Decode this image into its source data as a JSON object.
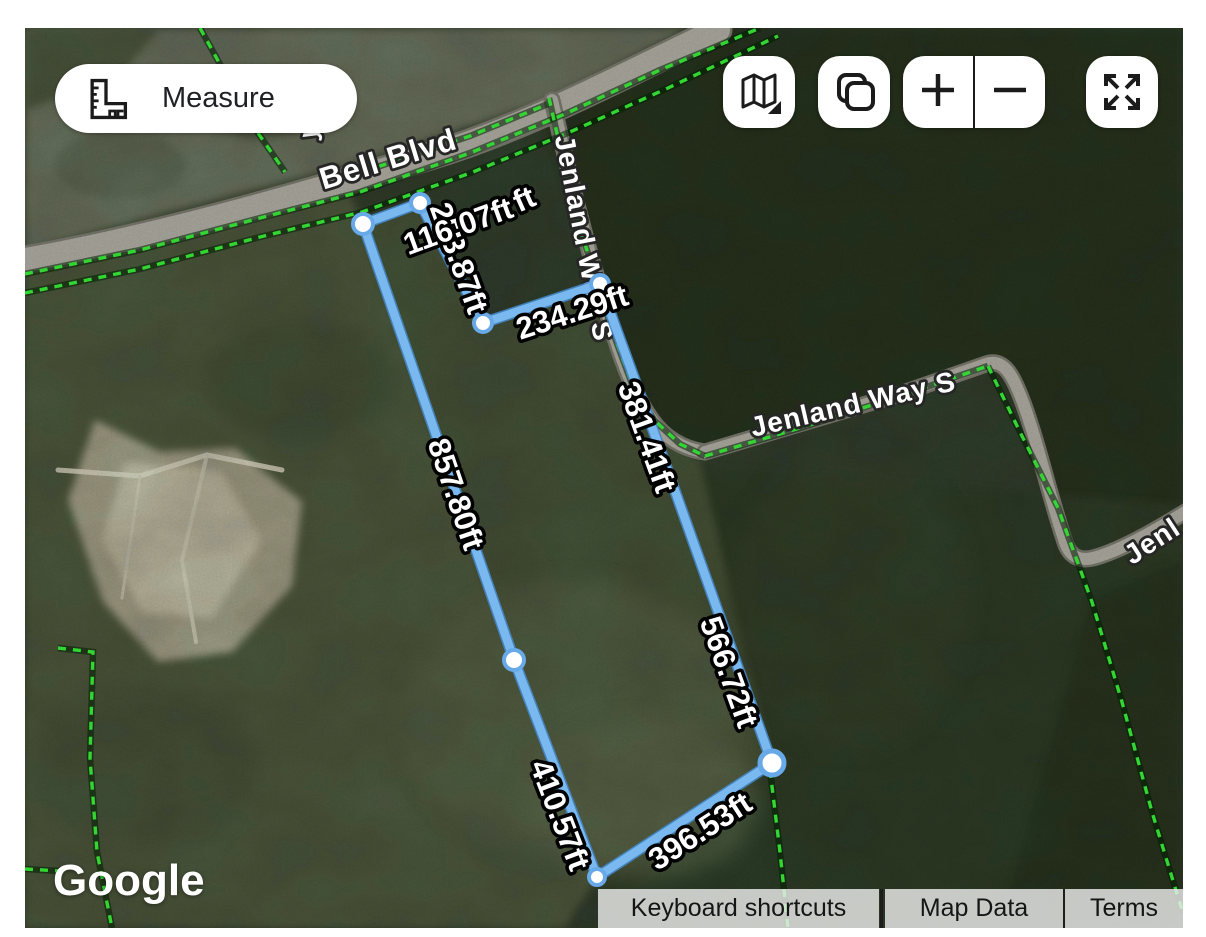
{
  "measure_tool": {
    "button_label": "Measure"
  },
  "attribution": {
    "logo": "Google",
    "keyboard_shortcuts": "Keyboard shortcuts",
    "map_data": "Map Data",
    "terms": "Terms"
  },
  "controls": [
    {
      "name": "map-type-button",
      "icon": "map-icon"
    },
    {
      "name": "copy-button",
      "icon": "copy-icon"
    },
    {
      "name": "zoom-in-button",
      "icon": "plus-icon"
    },
    {
      "name": "zoom-out-button",
      "icon": "minus-icon"
    },
    {
      "name": "fullscreen-button",
      "icon": "fullscreen-icon"
    }
  ],
  "colors": {
    "parcel_green": "#37e437",
    "parcel_shadow": "rgba(0,35,0,0.55)",
    "measure_blue": "#7ab8f0",
    "measure_casing": "#4487c8",
    "vertex_ring": "#68a9e8",
    "road_fill": "#a7a59b",
    "road_casing": "#75746a",
    "label_fill": "#ffffff",
    "label_stroke": "#000000"
  },
  "map": {
    "terrain": [
      {
        "t": "poly",
        "p": "25,28 690,28 545,102 340,168 180,210 25,252",
        "f": "#6e7465",
        "o": 1,
        "b": 1
      },
      {
        "t": "poly",
        "p": "25,28 160,28 118,78 25,110",
        "f": "#47523c",
        "o": 0.9,
        "b": 1
      },
      {
        "t": "ell",
        "cx": 262,
        "cy": 104,
        "rx": 58,
        "ry": 36,
        "f": "#4d5844",
        "o": 0.75,
        "b": 1
      },
      {
        "t": "ell",
        "cx": 120,
        "cy": 165,
        "rx": 65,
        "ry": 34,
        "f": "#5c6552",
        "o": 0.7,
        "b": 1
      },
      {
        "t": "poly",
        "p": "540,110 700,28 1183,28 1183,505 1068,552 1012,386 986,363 702,454 646,420 600,285",
        "f": "#232e1e",
        "o": 1,
        "b": 1
      },
      {
        "t": "poly",
        "p": "620,460 1183,505 1183,928 600,928",
        "f": "#2b3725",
        "o": 1,
        "b": 1
      },
      {
        "t": "poly",
        "p": "25,252 340,172 363,224 514,660 597,877 565,928 25,928",
        "f": "#4d5941",
        "o": 1,
        "b": 1
      },
      {
        "t": "poly",
        "p": "363,224 420,203 483,323 600,284 646,420 700,460 772,763 597,877 514,660",
        "f": "#46523a",
        "o": 0.95,
        "b": 1
      },
      {
        "t": "ell",
        "cx": 575,
        "cy": 720,
        "rx": 170,
        "ry": 140,
        "f": "#57624a",
        "o": 0.75,
        "b": 2
      },
      {
        "t": "ell",
        "cx": 640,
        "cy": 800,
        "rx": 120,
        "ry": 80,
        "f": "#5e6950",
        "o": 0.6,
        "b": 2
      },
      {
        "t": "ell",
        "cx": 850,
        "cy": 600,
        "rx": 120,
        "ry": 150,
        "f": "#323e2a",
        "o": 0.6,
        "b": 2
      },
      {
        "t": "poly",
        "p": "1090,600 1183,560 1183,928 1000,928",
        "f": "#222d1c",
        "o": 0.8,
        "b": 1
      },
      {
        "t": "ell",
        "cx": 300,
        "cy": 380,
        "rx": 95,
        "ry": 60,
        "f": "#3b4733",
        "o": 0.55,
        "b": 2
      },
      {
        "t": "ell",
        "cx": 145,
        "cy": 765,
        "rx": 115,
        "ry": 85,
        "f": "#3f4b37",
        "o": 0.5,
        "b": 2
      },
      {
        "t": "poly",
        "p": "95,420 160,452 235,448 302,502 292,586 232,652 158,662 103,602 68,500",
        "f": "#b2ac97",
        "o": 0.95,
        "b": 1
      },
      {
        "t": "poly",
        "p": "125,462 220,470 262,540 212,618 142,612 102,540",
        "f": "#cfc9b4",
        "o": 0.9,
        "b": 1
      },
      {
        "t": "path",
        "d": "M 58,470 L 140,476 L 207,455 L 282,470",
        "s": "#e7e2d1",
        "w": 5,
        "o": 0.9
      },
      {
        "t": "path",
        "d": "M 207,455 L 182,560 L 196,642",
        "s": "#ddd8c6",
        "w": 4,
        "o": 0.85
      },
      {
        "t": "path",
        "d": "M 140,476 L 122,598",
        "s": "#d8d3c1",
        "w": 3,
        "o": 0.8
      }
    ],
    "roads": [
      {
        "name": "bell-blvd",
        "d": "M 25,260 C 150,238 300,196 430,156 C 530,126 620,76 718,30",
        "w": 24
      },
      {
        "name": "jenland-way-s-north",
        "d": "M 552,100 C 566,160 580,220 597,278 C 612,330 628,388 652,420 C 664,437 682,449 705,452",
        "w": 12
      },
      {
        "name": "jenland-way-s-east",
        "d": "M 705,452 L 900,394 L 986,364 C 1004,358 1013,376 1022,400 C 1038,442 1052,506 1066,545 C 1071,557 1080,561 1093,558 C 1124,550 1168,523 1206,499",
        "w": 12
      }
    ],
    "parcel_lines": [
      "M 25,274 L 140,250 L 260,218 L 360,192 L 470,153 L 565,114 L 660,70 L 760,28",
      "M 25,293 L 140,269 L 260,237 L 362,212 L 473,172 L 570,132 L 668,88 L 778,36",
      "M 200,28 L 258,133 L 285,172",
      "M 350,176 L 470,136 L 548,104",
      "M 549,98 L 563,160 L 582,235 L 596,278 L 612,330 L 632,384 L 654,420 L 680,444 L 705,456",
      "M 705,456 L 800,428 L 900,396 L 988,366",
      "M 988,366 L 1020,432 L 1058,508 L 1092,602 L 1122,702 L 1152,812 L 1178,897 L 1188,928",
      "M 770,770 L 780,852 L 788,928",
      "M 58,648 L 93,652 L 90,758 L 97,852 L 112,928",
      "M 25,869 L 60,871"
    ],
    "labels": [
      {
        "k": "road",
        "t": "Bell Blvd",
        "x": 388,
        "y": 159,
        "r": -17,
        "s": 31
      },
      {
        "k": "road",
        "t": "Jenland Way S",
        "x": 584,
        "y": 238,
        "r": 79,
        "s": 28
      },
      {
        "k": "road",
        "t": "Jenland Way S",
        "x": 853,
        "y": 404,
        "r": -13,
        "s": 28
      },
      {
        "k": "road",
        "t": "Jenl",
        "x": 1152,
        "y": 541,
        "r": -33,
        "s": 28
      },
      {
        "k": "road",
        "t": "y",
        "x": 309,
        "y": 131,
        "r": -75,
        "s": 26
      }
    ]
  },
  "measurement": {
    "unit": "ft",
    "polygon_vertices": [
      {
        "x": 363,
        "y": 224
      },
      {
        "x": 420,
        "y": 203
      },
      {
        "x": 483,
        "y": 323
      },
      {
        "x": 600,
        "y": 284
      },
      {
        "x": 669,
        "y": 474
      },
      {
        "x": 772,
        "y": 763
      },
      {
        "x": 597,
        "y": 877
      },
      {
        "x": 514,
        "y": 660
      }
    ],
    "closed": true,
    "dots": [
      {
        "x": 363,
        "y": 224,
        "r": 10
      },
      {
        "x": 420,
        "y": 203,
        "r": 9
      },
      {
        "x": 483,
        "y": 323,
        "r": 9
      },
      {
        "x": 600,
        "y": 284,
        "r": 9
      },
      {
        "x": 772,
        "y": 763,
        "r": 12
      },
      {
        "x": 597,
        "y": 877,
        "r": 8
      },
      {
        "x": 514,
        "y": 660,
        "r": 10
      }
    ],
    "segment_labels": [
      {
        "t": "253.87ft",
        "x": 459,
        "y": 258,
        "r": 70
      },
      {
        "t": "857.80ft",
        "x": 456,
        "y": 494,
        "r": 71
      },
      {
        "t": "410.57ft",
        "x": 560,
        "y": 815,
        "r": 69
      },
      {
        "t": "396.53ft",
        "x": 700,
        "y": 831,
        "r": -33
      },
      {
        "t": "566.72ft",
        "x": 729,
        "y": 672,
        "r": 70
      },
      {
        "t": "381.41ft",
        "x": 647,
        "y": 437,
        "r": 70
      },
      {
        "t": "234.29ft",
        "x": 572,
        "y": 312,
        "r": -18
      },
      {
        "t": "ft",
        "x": 524,
        "y": 199,
        "r": -24,
        "fragment": true
      },
      {
        "t": "116.07ft",
        "x": 458,
        "y": 226,
        "r": -20
      }
    ]
  }
}
